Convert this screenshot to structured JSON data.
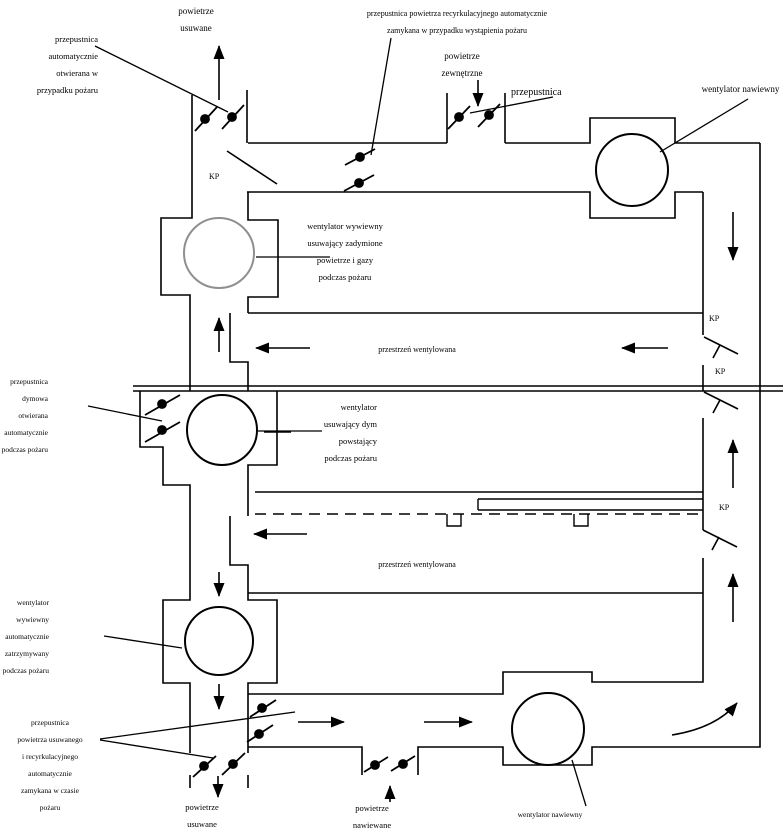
{
  "colors": {
    "background": "#ffffff",
    "line": "#000000",
    "smoke_fan_stroke": "#8f8f8f",
    "text": "#000000"
  },
  "labels": {
    "exhaust_air_top": [
      "powietrze",
      "usuwane"
    ],
    "damper_auto_open": [
      "przepustnica",
      "automatycznie",
      "otwierana w",
      "przypadku pożaru"
    ],
    "recirc_damper_note": [
      "przepustnica powietrza recyrkulacyjnego automatycznie",
      "zamykana w przypadku wystąpienia pożaru"
    ],
    "outside_air": [
      "powietrze",
      "zewnętrzne"
    ],
    "damper": "przepustnica",
    "supply_fan_top": "wentylator nawiewny",
    "kp": "KP",
    "smoke_exhaust_fan_top": [
      "wentylator wywiewny",
      "usuwający zadymione",
      "powietrze i gazy",
      "podczas pożaru"
    ],
    "ventilated_space_1": "przestrzeń wentylowana",
    "smoke_damper": [
      "przepustnica",
      "dymowa",
      "otwierana",
      "automatycznie",
      "podczas pożaru"
    ],
    "smoke_extract_fan": [
      "wentylator",
      "usuwający dym",
      "powstający",
      "podczas pożaru"
    ],
    "ventilated_space_2": "przestrzeń wentylowana",
    "exhaust_fan_stopped": [
      "wentylator",
      "wywiewny",
      "automatycznie",
      "zatrzymywany",
      "podczas pożaru"
    ],
    "exhaust_recirc_damper": [
      "przepustnica",
      "powietrza usuwanego",
      "i recyrkulacyjnego",
      "automatycznie",
      "zamykana w czasie",
      "pożaru"
    ],
    "exhaust_air_bottom": [
      "powietrze",
      "usuwane"
    ],
    "supply_air_bottom": [
      "powietrze",
      "nawiewane"
    ],
    "supply_fan_bottom": "wentylator nawiewny"
  }
}
